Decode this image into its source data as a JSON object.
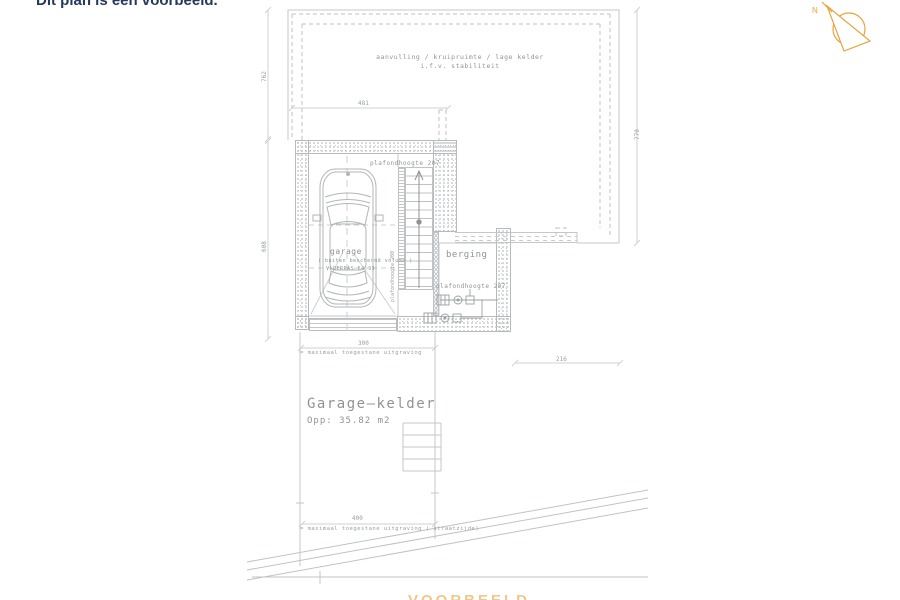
{
  "banner": {
    "title": "Dit plan is een voorbeeld."
  },
  "compass": {
    "label": "N"
  },
  "crawlspace": {
    "line1": "aanvulling / kruipruimte / lage kelder",
    "line2": "i.f.v. stabiliteit"
  },
  "garage": {
    "ceiling_note": "plafondhoogte 207",
    "name": "garage",
    "volume_note": "( buiten beschermd volume )",
    "floor_note": "VLOERPAS 64.93"
  },
  "stairwell": {
    "ceiling_note": "plafondhoogte 200"
  },
  "berging": {
    "name": "berging",
    "ceiling_note": "plafondhoogte 207"
  },
  "summary": {
    "title": "Garage—kelder",
    "area": "Opp: 35.82 m2"
  },
  "dimensions": {
    "crawl_left_height": "762",
    "crawl_top_width": "481",
    "crawl_right_height": "770",
    "garage_side_height": "608",
    "excavation_width": "300",
    "excavation_note": "= maximaal toegestane uitgraving",
    "berging_width": "216",
    "street_width": "400",
    "street_note": "= maximaal toegestane uitgraving ( straatzijde)"
  },
  "watermark": "VOORBEELD",
  "colors": {
    "accent": "#E8A33D",
    "title": "#25395C",
    "line": "#C3C7C9",
    "text": "#8F9396"
  }
}
